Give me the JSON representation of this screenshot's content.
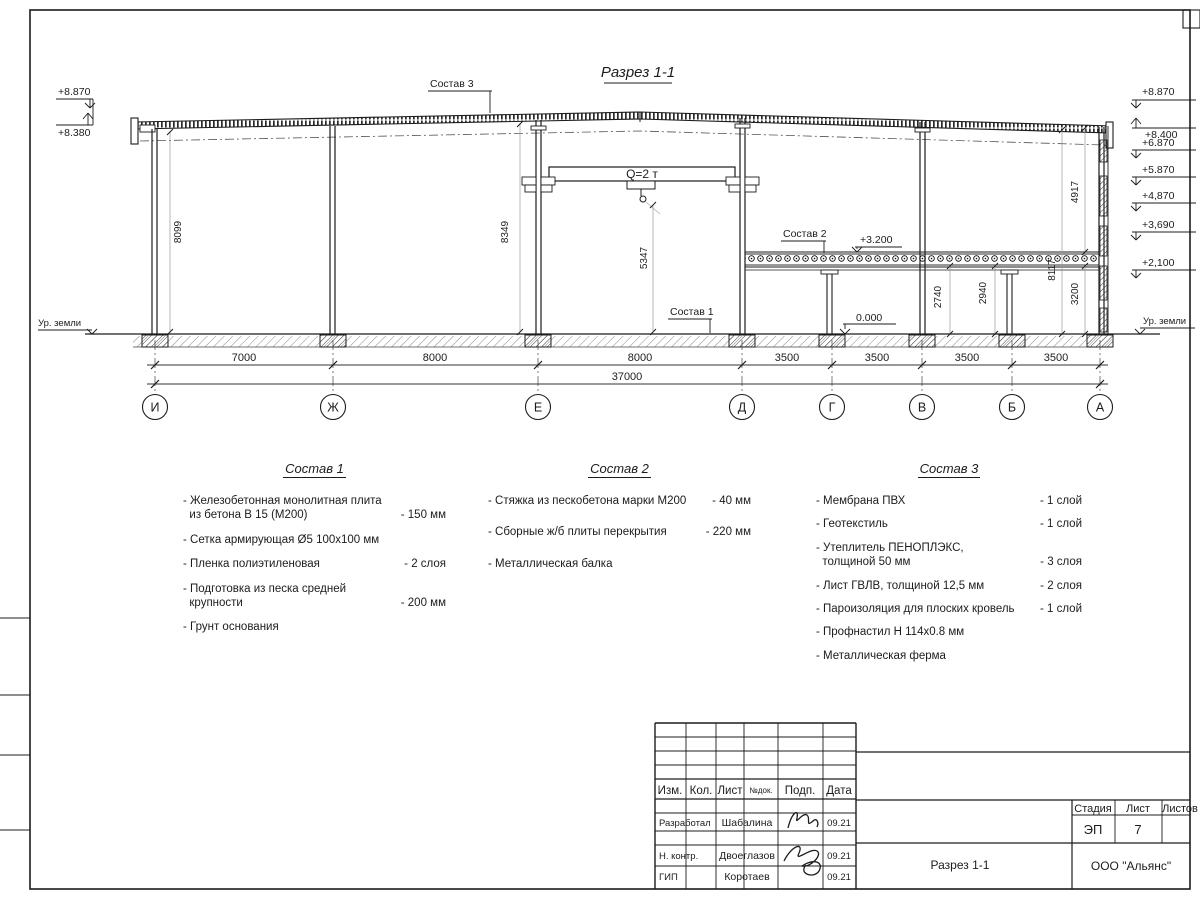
{
  "drawing": {
    "title": "Разрез 1-1",
    "crane": "Q=2 т",
    "callout_sostav1": "Состав 1",
    "callout_sostav2": "Состав 2",
    "callout_sostav3": "Состав 3",
    "ground_left": "Ур. земли",
    "ground_right": "Ур. земли",
    "elev": {
      "left_top": "+8.870",
      "left_bottom": "+8.380",
      "right": [
        "+8.870",
        "+8.400",
        "+6.870",
        "+5.870",
        "+4,870",
        "+3,690",
        "+2,100"
      ],
      "mezz": "+3.200",
      "zero": "0.000"
    },
    "vdims": {
      "v8099": "8099",
      "v8349": "8349",
      "v5347": "5347",
      "v2740": "2740",
      "v2940": "2940",
      "v3200": "3200",
      "v8117": "8117",
      "v4917": "4917"
    },
    "hdims": [
      "7000",
      "8000",
      "8000",
      "3500",
      "3500",
      "3500",
      "3500"
    ],
    "total": "37000",
    "axes": [
      "И",
      "Ж",
      "Е",
      "Д",
      "Г",
      "В",
      "Б",
      "А"
    ]
  },
  "sostav1": {
    "title": "Состав 1",
    "items": [
      {
        "text": "- Железобетонная  монолитная плита\n  из бетона В 15 (М200)",
        "value": "- 150 мм"
      },
      {
        "text": "- Сетка армирующая Ø5 100х100 мм",
        "value": ""
      },
      {
        "text": "- Пленка полиэтиленовая",
        "value": "- 2 слоя"
      },
      {
        "text": "- Подготовка из песка средней\n  крупности",
        "value": "- 200 мм"
      },
      {
        "text": "- Грунт основания",
        "value": ""
      }
    ]
  },
  "sostav2": {
    "title": "Состав 2",
    "items": [
      {
        "text": "- Стяжка из пескобетона марки М200",
        "value": "- 40 мм"
      },
      {
        "text": "- Сборные ж/б плиты перекрытия",
        "value": "- 220 мм"
      },
      {
        "text": "- Металлическая балка",
        "value": ""
      }
    ]
  },
  "sostav3": {
    "title": "Состав 3",
    "items": [
      {
        "text": "- Мембрана ПВХ",
        "value": "- 1 слой"
      },
      {
        "text": "- Геотекстиль",
        "value": "- 1 слой"
      },
      {
        "text": "- Утеплитель ПЕНОПЛЭКС,\n  толщиной 50 мм",
        "value": "- 3 слоя"
      },
      {
        "text": "- Лист ГВЛВ, толщиной 12,5 мм",
        "value": "- 2 слоя"
      },
      {
        "text": "- Пароизоляция для плоских кровель",
        "value": "- 1 слой"
      },
      {
        "text": "- Профнастил Н 114х0.8 мм",
        "value": ""
      },
      {
        "text": "- Металлическая ферма",
        "value": ""
      }
    ]
  },
  "stamp": {
    "cols": [
      "Изм.",
      "Кол.",
      "Лист",
      "№док.",
      "Подп.",
      "Дата"
    ],
    "rows": [
      {
        "role": "Разработал",
        "name": "Шабалина",
        "date": "09.21"
      },
      {
        "role": "Н. контр.",
        "name": "Двоеглазов",
        "date": "09.21"
      },
      {
        "role": "ГИП",
        "name": "Коротаев",
        "date": "09.21"
      }
    ],
    "stage_label": "Стадия",
    "list_label": "Лист",
    "listov_label": "Листов",
    "stage": "ЭП",
    "list_no": "7",
    "doc_title": "Разрез 1-1",
    "org": "ООО \"Альянс\""
  }
}
